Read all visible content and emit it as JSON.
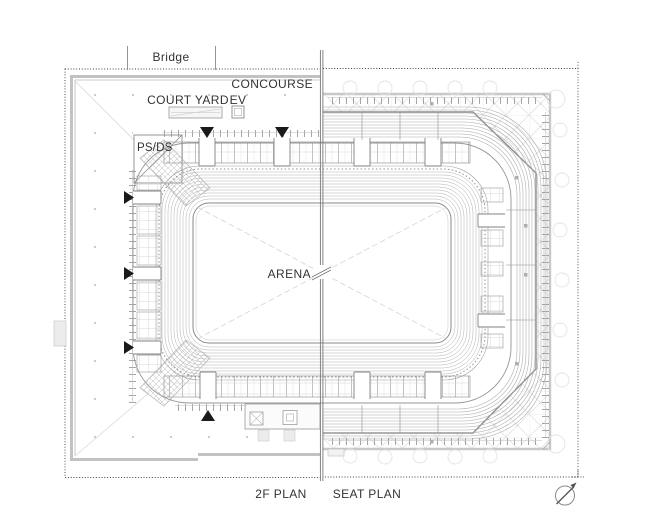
{
  "drawing": {
    "labels": {
      "bridge": "Bridge",
      "concourse": "CONCOURSE",
      "court_yard": "COURT YARD",
      "ev": "EV",
      "ps_ds": "PS/DS",
      "arena": "ARENA"
    },
    "captions": {
      "left_plan": "2F PLAN",
      "right_plan": "SEAT PLAN"
    },
    "colors": {
      "ink": "#333333",
      "line_dark": "#8a8a8a",
      "line_mid": "#b0b0b0",
      "line_light": "#dcdcdc",
      "wall_gray": "#c2c2c2",
      "marker_black": "#1a1a1a"
    }
  }
}
